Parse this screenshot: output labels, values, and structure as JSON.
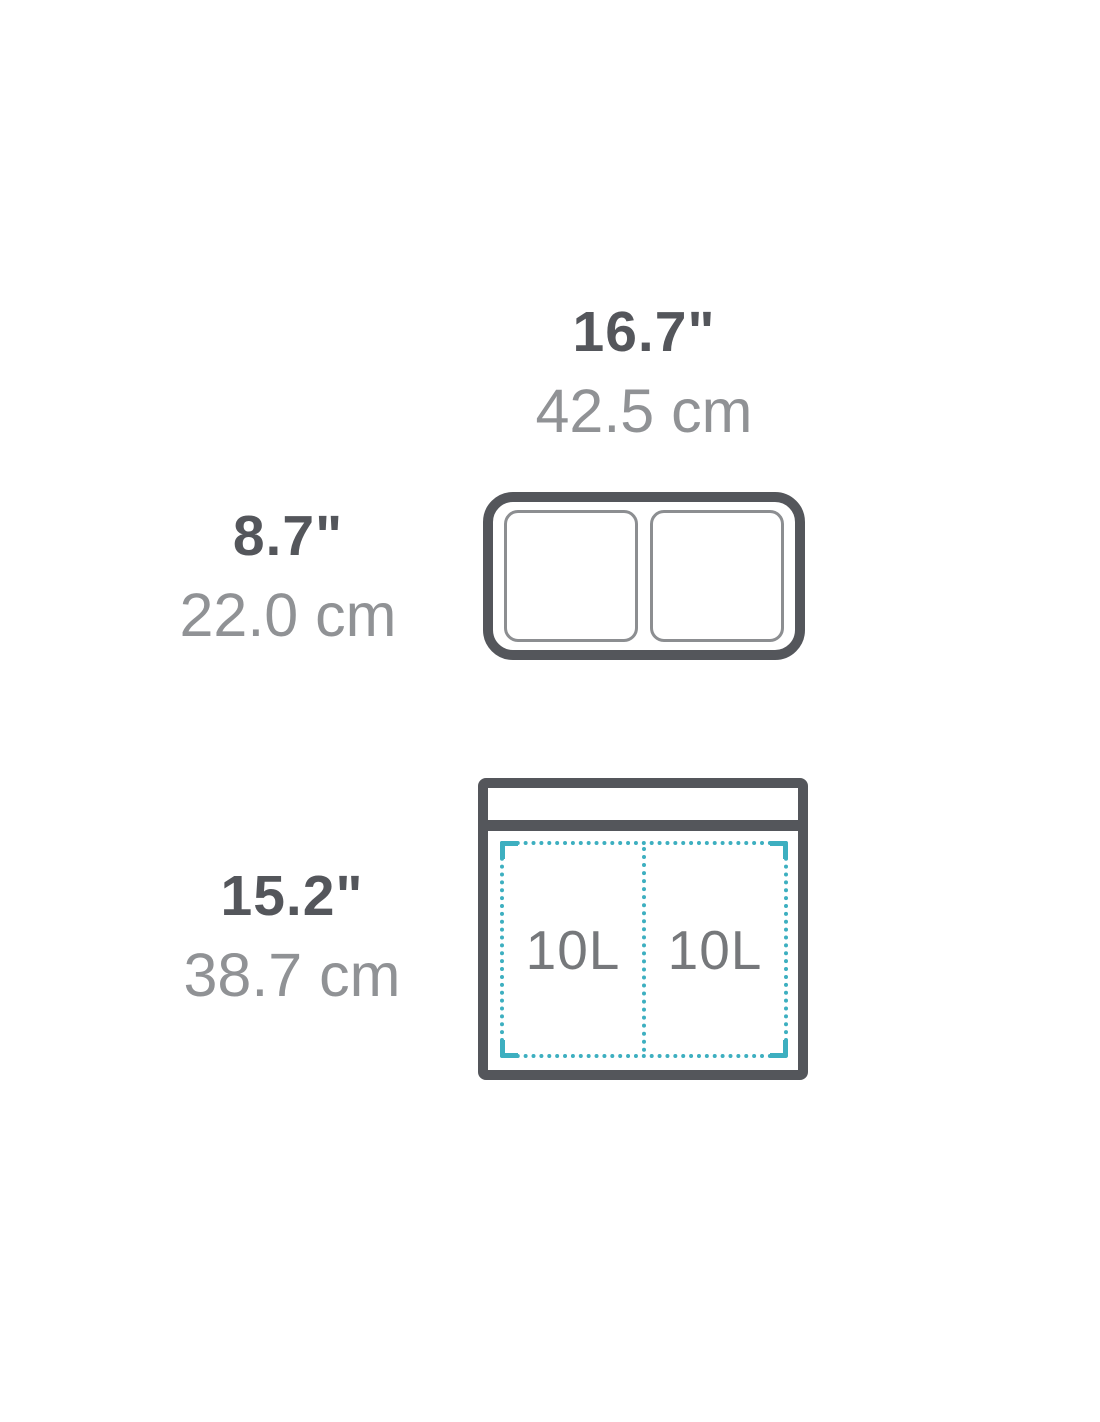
{
  "diagram": {
    "description": "dual-compartment bin dimension diagram with top view and front view",
    "width_label": {
      "inches": "16.7\"",
      "cm": "42.5 cm"
    },
    "depth_label": {
      "inches": "8.7\"",
      "cm": "22.0 cm"
    },
    "height_label": {
      "inches": "15.2\"",
      "cm": "38.7 cm"
    },
    "capacity": {
      "left": "10L",
      "right": "10L"
    },
    "colors": {
      "outline_dark": "#54565b",
      "inches_text": "#54565b",
      "cm_text": "#909295",
      "capacity_text": "#76787b",
      "compartment_line": "#8c8e91",
      "liner_dashed_teal": "#3dafc0",
      "background": "#ffffff"
    }
  }
}
